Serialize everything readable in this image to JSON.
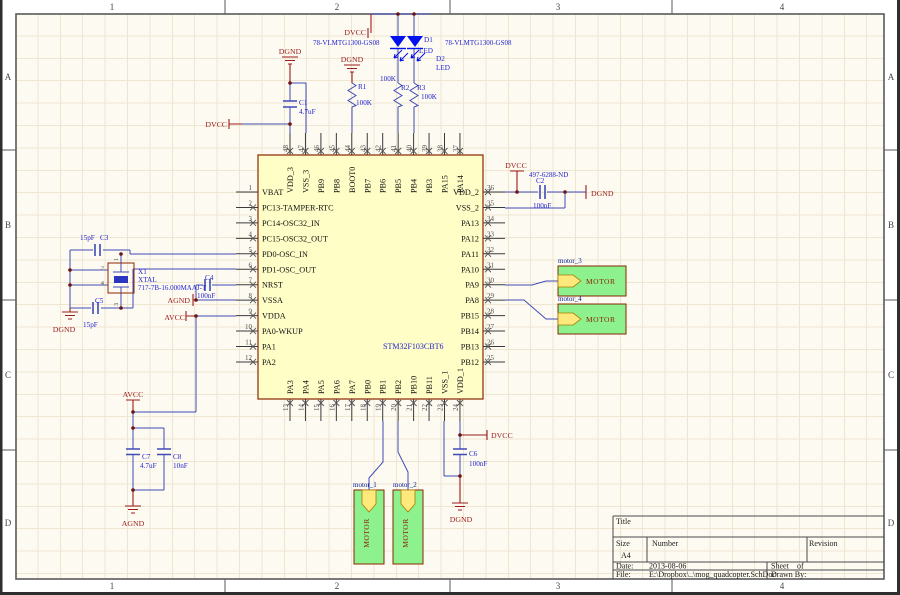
{
  "colors": {
    "wire": "#3f4bb8",
    "power": "#9b1b1b",
    "component": "#1f1fd0",
    "ic_fill": "#fffec6",
    "ic_border": "#8b2500",
    "motor_fill": "#8df18d",
    "motor_border": "#8b2500",
    "port_fill": "#ffe87c",
    "led": "#0011ee",
    "net_label": "#001a99",
    "sheet_bg": "#fdfbf1",
    "grid": "#efe6d2"
  },
  "sheet": {
    "zones_top": [
      "1",
      "2",
      "3",
      "4"
    ],
    "zones_side": [
      "A",
      "B",
      "C",
      "D"
    ],
    "title_block": {
      "title_label": "Title",
      "size_label": "Size",
      "size_value": "A4",
      "number_label": "Number",
      "revision_label": "Revision",
      "date_label": "Date:",
      "date_value": "2013-08-06",
      "sheet_label": "Sheet",
      "of_label": "of",
      "file_label": "File:",
      "file_value": "E:\\Dropbox\\..\\mog_quadcopter.SchDoc",
      "drawn_by_label": "Drawn By:"
    }
  },
  "power": {
    "dvcc": "DVCC",
    "dgnd": "DGND",
    "avcc": "AVCC",
    "agnd": "AGND"
  },
  "mcu": {
    "part": "STM32F103CBT6",
    "left_pins": [
      {
        "num": "1",
        "name": "VBAT",
        "nc": false
      },
      {
        "num": "2",
        "name": "PC13-TAMPER-RTC"
      },
      {
        "num": "3",
        "name": "PC14-OSC32_IN"
      },
      {
        "num": "4",
        "name": "PC15-OSC32_OUT"
      },
      {
        "num": "5",
        "name": "PD0-OSC_IN"
      },
      {
        "num": "6",
        "name": "PD1-OSC_OUT"
      },
      {
        "num": "7",
        "name": "NRST"
      },
      {
        "num": "8",
        "name": "VSSA"
      },
      {
        "num": "9",
        "name": "VDDA"
      },
      {
        "num": "10",
        "name": "PA0-WKUP"
      },
      {
        "num": "11",
        "name": "PA1"
      },
      {
        "num": "12",
        "name": "PA2"
      }
    ],
    "right_pins": [
      {
        "num": "36",
        "name": "VDD_2"
      },
      {
        "num": "35",
        "name": "VSS_2"
      },
      {
        "num": "34",
        "name": "PA13"
      },
      {
        "num": "33",
        "name": "PA12"
      },
      {
        "num": "32",
        "name": "PA11"
      },
      {
        "num": "31",
        "name": "PA10"
      },
      {
        "num": "30",
        "name": "PA9"
      },
      {
        "num": "29",
        "name": "PA8"
      },
      {
        "num": "28",
        "name": "PB15"
      },
      {
        "num": "27",
        "name": "PB14"
      },
      {
        "num": "26",
        "name": "PB13"
      },
      {
        "num": "25",
        "name": "PB12"
      }
    ],
    "top_pins": [
      {
        "num": "48",
        "name": "VDD_3"
      },
      {
        "num": "47",
        "name": "VSS_3"
      },
      {
        "num": "46",
        "name": "PB9"
      },
      {
        "num": "45",
        "name": "PB8"
      },
      {
        "num": "44",
        "name": "BOOT0"
      },
      {
        "num": "43",
        "name": "PB7"
      },
      {
        "num": "42",
        "name": "PB6"
      },
      {
        "num": "41",
        "name": "PB5"
      },
      {
        "num": "40",
        "name": "PB4"
      },
      {
        "num": "39",
        "name": "PB3"
      },
      {
        "num": "38",
        "name": "PA15"
      },
      {
        "num": "37",
        "name": "PA14"
      }
    ],
    "bottom_pins": [
      {
        "num": "13",
        "name": "PA3"
      },
      {
        "num": "14",
        "name": "PA4"
      },
      {
        "num": "15",
        "name": "PA5"
      },
      {
        "num": "16",
        "name": "PA6"
      },
      {
        "num": "17",
        "name": "PA7"
      },
      {
        "num": "18",
        "name": "PB0"
      },
      {
        "num": "19",
        "name": "PB1"
      },
      {
        "num": "20",
        "name": "PB2"
      },
      {
        "num": "21",
        "name": "PB10"
      },
      {
        "num": "22",
        "name": "PB11"
      },
      {
        "num": "23",
        "name": "VSS_1"
      },
      {
        "num": "24",
        "name": "VDD_1"
      }
    ]
  },
  "components": {
    "c1": {
      "ref": "C1",
      "value": "4.7uF"
    },
    "c2": {
      "ref": "C2",
      "value": "100nF",
      "part": "497-6288-ND"
    },
    "c3": {
      "ref": "C3",
      "value": "15pF"
    },
    "c4": {
      "ref": "C4",
      "value": "100nF"
    },
    "c5": {
      "ref": "C5",
      "value": "15pF"
    },
    "c6": {
      "ref": "C6",
      "value": "100nF"
    },
    "c7": {
      "ref": "C7",
      "value": "4.7uF"
    },
    "c8": {
      "ref": "C8",
      "value": "10nF"
    },
    "r1": {
      "ref": "R1",
      "value": "100K"
    },
    "r2": {
      "ref": "R2",
      "value": "100K"
    },
    "r3": {
      "ref": "R3",
      "value": "100K"
    },
    "d1": {
      "ref": "D1",
      "type": "LED",
      "part": "78-VLMTG1300-GS08"
    },
    "d2": {
      "ref": "D2",
      "type": "LED",
      "part": "78-VLMTG1300-GS08"
    },
    "x1": {
      "ref": "X1",
      "type": "XTAL",
      "part": "717-7B-16.000MAAJ-T",
      "pins": [
        "1",
        "2",
        "3",
        "4"
      ]
    }
  },
  "motors": {
    "port_text": "MOTOR",
    "instances": [
      {
        "label": "motor_3"
      },
      {
        "label": "motor_4"
      },
      {
        "label": "motor_1"
      },
      {
        "label": "motor_2"
      }
    ]
  }
}
